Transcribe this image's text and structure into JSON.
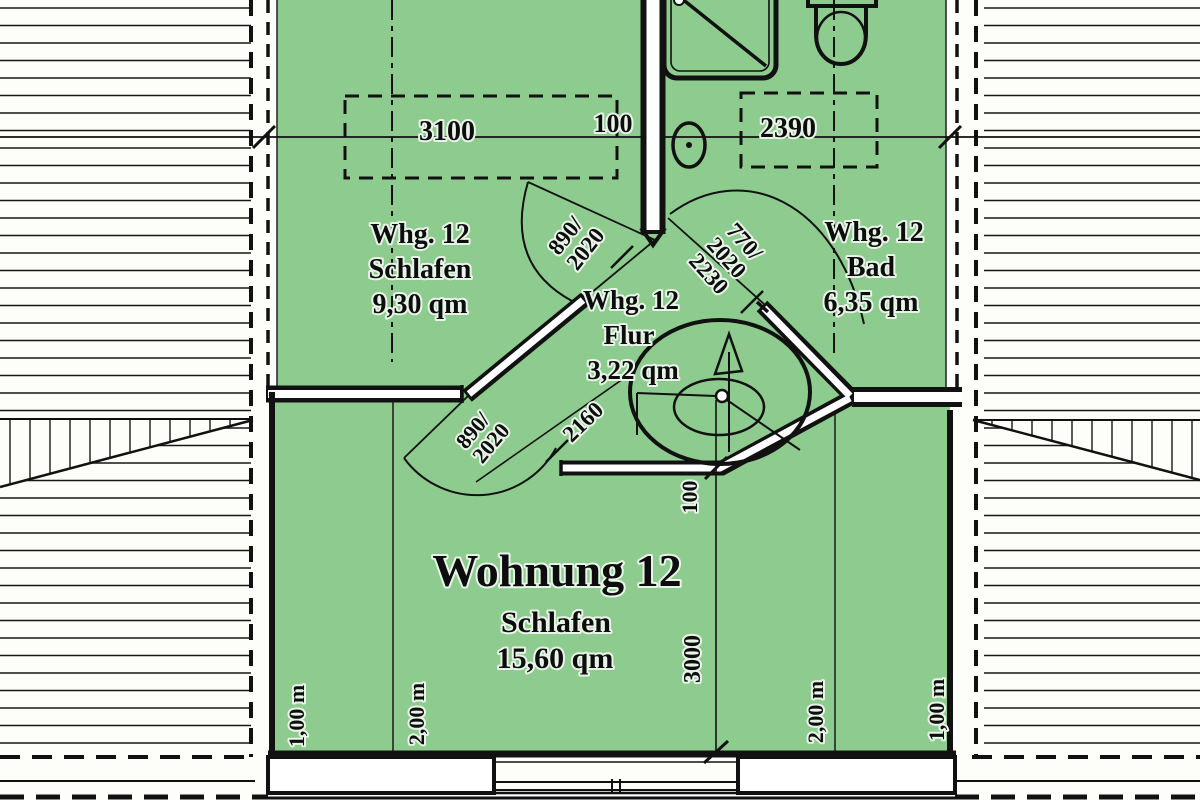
{
  "plan": {
    "title": "Wohnung 12 floor plan",
    "colors": {
      "floor_green": "#8ecb8e",
      "line": "#141414",
      "paper": "#fdfdfa"
    }
  },
  "rooms": {
    "schlafen_top": {
      "whg": "Whg. 12",
      "name": "Schlafen",
      "area": "9,30 qm"
    },
    "flur": {
      "whg": "Whg. 12",
      "name": "Flur",
      "area": "3,22 qm"
    },
    "bad": {
      "whg": "Whg. 12",
      "name": "Bad",
      "area": "6,35 qm"
    },
    "schlafen_main": {
      "whg": "Wohnung 12",
      "name": "Schlafen",
      "area": "15,60 qm"
    }
  },
  "dimensions": {
    "roof_window_left": "3100",
    "wall_top": "100",
    "roof_window_right": "2390",
    "corridor": "2160",
    "stair_wall": "100",
    "room_depth": "3000"
  },
  "doors": {
    "top_line1": "890/",
    "top_line2": "2020",
    "bad_line1": "770/",
    "bad_line2": "2020",
    "bad_line3": "2230",
    "low_line1": "890/",
    "low_line2": "2020"
  },
  "heights": {
    "left_outer": "1,00 m",
    "left_inner": "2,00 m",
    "right_inner": "2,00 m",
    "right_outer": "1,00 m"
  }
}
